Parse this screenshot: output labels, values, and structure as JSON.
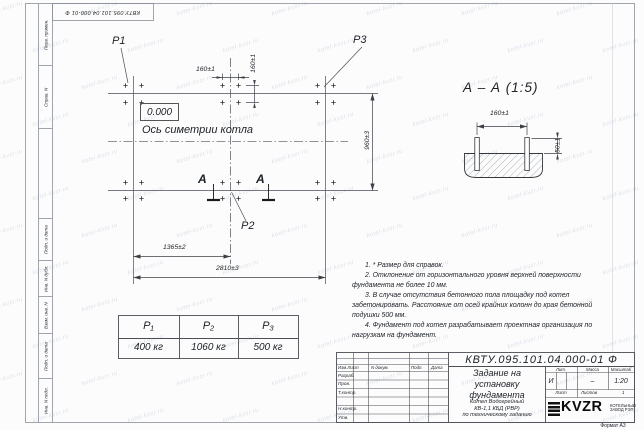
{
  "doc_number": "КВТУ.095.101.04.000-01 Ф",
  "watermark": {
    "text": "kotel-kvzr.ru"
  },
  "margin_columns": {
    "c1": "Перв. примен.",
    "c2": "Справ. N",
    "c3": "Подп. и дата",
    "c4": "Инв. N дубл.",
    "c5": "Взам. инв. N",
    "c6": "Подп. и дата",
    "c7": "Инв. N подл."
  },
  "plan": {
    "p1": "P1",
    "p2": "P2",
    "p3": "P3",
    "elevation": "0.000",
    "axis_label": "Ось симетрии котла",
    "section_letter": "А",
    "dim_160_h": "160±1",
    "dim_160_v": "160±1",
    "dim_960": "960±3",
    "dim_1365": "1365±2",
    "dim_2810": "2810±3"
  },
  "section": {
    "title": "А – А (1:5)",
    "dim_160": "160±1",
    "dim_50": "50±1"
  },
  "loads_table": {
    "headers": [
      "P₁",
      "P₂",
      "P₃"
    ],
    "values": [
      "400 кг",
      "1060 кг",
      "500 кг"
    ]
  },
  "notes": [
    "1. * Размер для справок.",
    "2. Отклонение от горизонтального уровня верхней поверхности фундамента не более 10 мм.",
    "3. В случае отсутствия бетонного пола площадку под котел забетонировать. Расстояние от осей крайних колонн до края бетонной подушки 500 мм.",
    "4. Фундамент под котел разрабатывает проектная организация по нагрузкам на фундамент."
  ],
  "title_block": {
    "name": "Задание на\nустановку\nфундамента",
    "subtitle": "Котел Водогрейный\nКВ-1,1 КБД (РВР)\nпо техническому заданию",
    "col_izm": "Изм.Лист",
    "col_doc": "N докум.",
    "col_podp": "Подп.",
    "col_data": "Дата",
    "row_razrab": "Разраб.",
    "row_prov": "Пров.",
    "row_tkontr": "Т.контр.",
    "row_nkontr": "Н.контр.",
    "row_utv": "Утв.",
    "lit_label": "Лит.",
    "mass_label": "Масса",
    "scale_label": "Масштаб",
    "lit_value": "И",
    "mass_value": "–",
    "scale_value": "1:20",
    "sheet_label": "Лист",
    "sheets_label": "Листов",
    "sheets_value": "1",
    "brand": "KVZR",
    "brand_sub": "КОТЕЛЬНЫЙ\nЗАВОД РЭП",
    "format_label": "Формат А3"
  }
}
